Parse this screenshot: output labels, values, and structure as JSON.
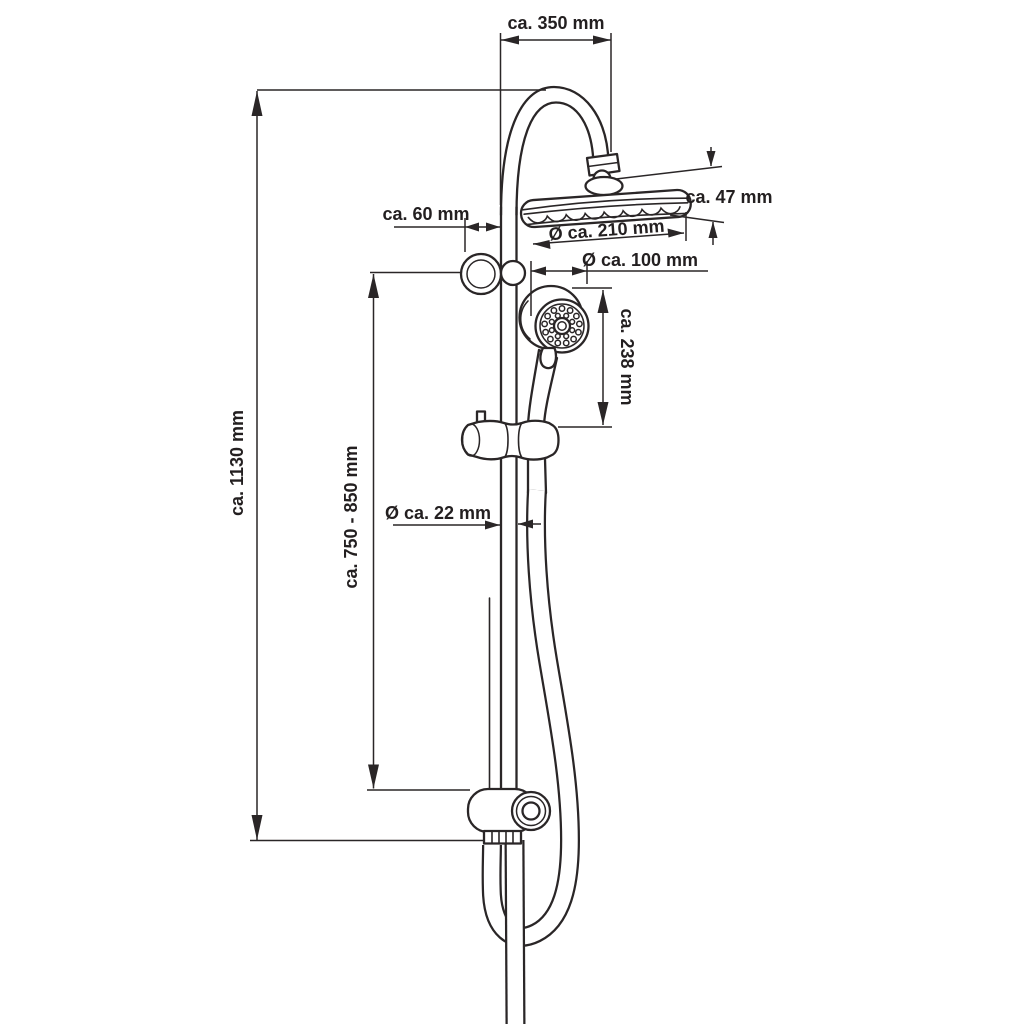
{
  "diagram": {
    "kind": "technical-dimension-drawing",
    "subject": "shower column set with overhead rain shower and hand shower",
    "background_color": "#ffffff",
    "line_color": "#2a2627",
    "text_color": "#231f20",
    "dimensions": {
      "top_width": "ca. 350 mm",
      "head_height": "ca. 47 mm",
      "head_diameter": "Ø ca. 210 mm",
      "bracket_depth": "ca. 60 mm",
      "hand_shower_diameter": "Ø ca. 100 mm",
      "hand_shower_length": "ca. 238 mm",
      "total_height": "ca. 1130 mm",
      "bracket_span": "ca. 750 - 850 mm",
      "rail_diameter": "Ø ca. 22 mm"
    }
  }
}
